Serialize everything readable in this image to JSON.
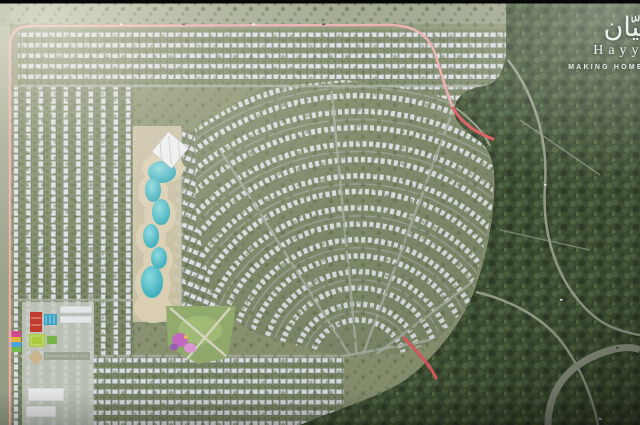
{
  "brand": {
    "name_arabic": "حيّان",
    "name_latin": "Hayyan",
    "tagline": "MAKING HOMES HUMAN"
  },
  "palette": {
    "lagoon_water": "#35aebf",
    "beach_sand": "#dacfb3",
    "rooftop_white": "#dde0e3",
    "housing_olive": "#7e8a6b",
    "forest_green": "#3e5033",
    "boundary_pink": "#ecabad",
    "accent_red": "#e05a5e",
    "school_red": "#c23b2e",
    "field_green": "#a9c93f",
    "pool_blue": "#3a9fc0",
    "playground_pink": "#c46cc0"
  }
}
